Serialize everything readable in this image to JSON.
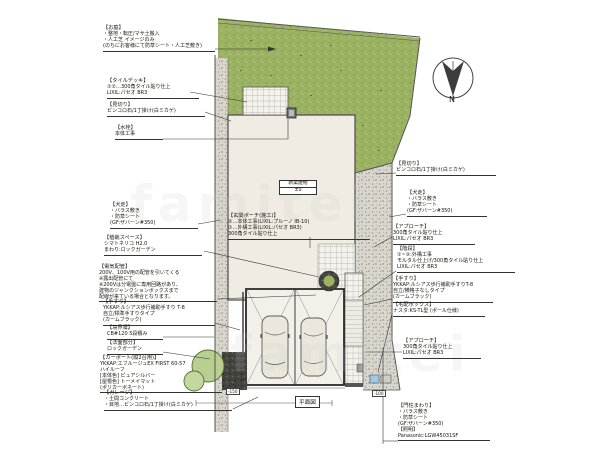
{
  "drawing": {
    "plan_label": "平面図",
    "compass_label": "N",
    "building": {
      "name": "新築建物",
      "level": "±0"
    },
    "dimension_tags": [
      "-150",
      "-100"
    ],
    "watermark": "famitei"
  },
  "annotations": {
    "left": [
      {
        "heading": "【お庭】",
        "lines": [
          "・整地・転圧/マサ土搬入",
          "・人工芝 イメージのみ",
          "(のちにお客様にて防草シート・人工芝敷き)"
        ]
      },
      {
        "heading": "【タイルデッキ】",
        "lines": [
          "①②…300角タイル貼り仕上",
          "LIXIL:パセオ BR3"
        ]
      },
      {
        "heading": "【見切り】",
        "lines": [
          "ピンコロ石/1丁掛け(白ミカゲ)"
        ]
      },
      {
        "heading": "【水栓】",
        "lines": [
          "本体工事"
        ]
      },
      {
        "heading": "【犬走】",
        "lines": [
          "・バラス敷き",
          "・防草シート",
          "(GF:ザバーン#350)"
        ]
      },
      {
        "heading": "【植栽スペース】",
        "lines": [
          "シマトネリコ H2.0",
          "まわり:ロックガーデン"
        ]
      },
      {
        "heading": "【電気配管】",
        "lines": [
          "200V、100V用の配管を引いてくる",
          "※露出配管にて",
          "※200Vは分電盤に専用回路があり、",
          "建物のジャンクションボックスまで",
          "配線が来ている場合となります。"
        ]
      },
      {
        "heading": "【手すり】",
        "lines": [
          "YKKAP:ルシアス歩行補助手すり T-8",
          "自立/標準手すりタイプ",
          "(カームブラック)"
        ]
      },
      {
        "heading": "【境界塀】",
        "lines": [
          "CB#120 5段積み"
        ]
      },
      {
        "heading": "【法面部分】",
        "lines": [
          "ロックガーデン"
        ]
      },
      {
        "heading": "【カーポート(縦2台用)】",
        "lines": [
          "YKKAP:エフルージュEX FIRST 60-57",
          "ハイルーフ",
          "[本体色] ピュアシルバー",
          "[屋根色] トーメイマット",
          "(ポリカーボネート)"
        ]
      },
      {
        "heading": "【ガレージ】",
        "lines": [
          "・土間コンクリート",
          "・目地…ピンコロ石/1丁掛け(白ミカゲ)"
        ]
      }
    ],
    "right": [
      {
        "heading": "【見切り】",
        "lines": [
          "ピンコロ石/1丁掛け(白ミカゲ)"
        ]
      },
      {
        "heading": "【犬走】",
        "lines": [
          "・バラス敷き",
          "・防草シート",
          "(GF:ザバーン#350)"
        ]
      },
      {
        "heading": "【アプローチ】",
        "lines": [
          "300角タイル貼り仕上",
          "LIXIL:パセオ BR3"
        ]
      },
      {
        "heading": "【階段】",
        "lines": [
          "①~③:外構工事",
          "モルタル仕上げ/300角タイル貼り仕上",
          "LIXIL:パセオ BR3"
        ]
      },
      {
        "heading": "【手すり】",
        "lines": [
          "YKKAP:ルシアス歩行補助手すりT-8",
          "自立/横格子なしタイプ",
          "(カームブラック)"
        ]
      },
      {
        "heading": "【宅配ボックス】",
        "lines": [
          "ナスタ:KS-TL型 (ポール仕様)"
        ]
      },
      {
        "heading": "【アプローチ】",
        "lines": [
          "300角タイル貼り仕上",
          "LIXIL:パセオ BR3"
        ]
      },
      {
        "heading": "【門柱まわり】",
        "lines": [
          "・バラス敷き",
          "・防草シート",
          "(GF:ザバーン#350)",
          "【照明】",
          "Panasonic:LGW45031SF"
        ]
      }
    ],
    "center": [
      {
        "heading": "【玄関ポーチ(施工)】",
        "lines": [
          "②…本体工事(LIXIL:プルーノ IB-10)",
          "①…外構工事(LIXIL:パセオ BR3)",
          "300角タイル貼り仕上"
        ]
      }
    ]
  }
}
